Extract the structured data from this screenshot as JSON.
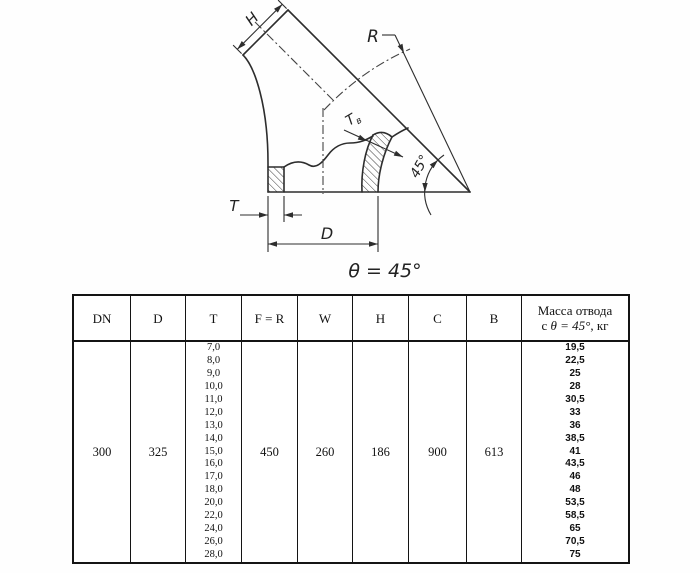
{
  "diagram": {
    "labels": {
      "h": "H",
      "r": "R",
      "t_wall": "T",
      "d": "D",
      "tb_main": "T",
      "tb_sub": "в",
      "angle_dim": "45°",
      "caption": "θ = 45°"
    }
  },
  "table": {
    "headers": [
      "DN",
      "D",
      "T",
      "F = R",
      "W",
      "H",
      "C",
      "B"
    ],
    "mass_header": {
      "line1": "Масса отвода",
      "pre": "с ",
      "math": "θ = 45°",
      "post": ", кг"
    },
    "values": {
      "dn": "300",
      "d": "325",
      "f_r": "450",
      "w": "260",
      "h": "186",
      "c": "900",
      "b": "613"
    },
    "t_values": [
      "7,0",
      "8,0",
      "9,0",
      "10,0",
      "11,0",
      "12,0",
      "13,0",
      "14,0",
      "15,0",
      "16,0",
      "17,0",
      "18,0",
      "20,0",
      "22,0",
      "24,0",
      "26,0",
      "28,0"
    ],
    "mass_values": [
      "19,5",
      "22,5",
      "25",
      "28",
      "30,5",
      "33",
      "36",
      "38,5",
      "41",
      "43,5",
      "46",
      "48",
      "53,5",
      "58,5",
      "65",
      "70,5",
      "75"
    ]
  }
}
